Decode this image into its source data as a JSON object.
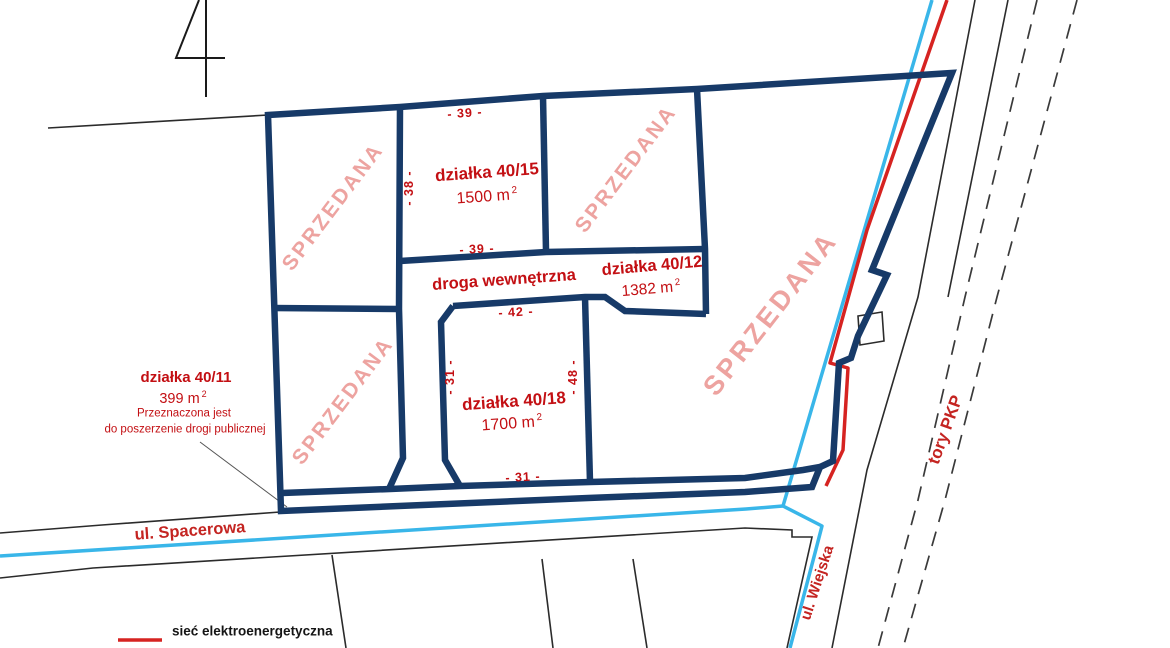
{
  "map": {
    "parcel_number": "4",
    "sold_label": "SPRZEDANA",
    "road_label": "droga wewnętrzna",
    "plots": {
      "p40_15": {
        "name": "działka 40/15",
        "area": "1500 m",
        "area_sup": "2"
      },
      "p40_12": {
        "name": "działka 40/12",
        "area": "1382 m",
        "area_sup": "2"
      },
      "p40_18": {
        "name": "działka 40/18",
        "area": "1700 m",
        "area_sup": "2"
      },
      "p40_11": {
        "name": "działka 40/11",
        "area": "399 m",
        "area_sup": "2",
        "note_line1": "Przeznaczona jest",
        "note_line2": "do poszerzenie drogi publicznej"
      }
    },
    "dims": {
      "top_39": "- 39 -",
      "bottom_39": "- 39 -",
      "left_38": "- 38 -",
      "top_42": "- 42 -",
      "left_31": "- 31 -",
      "right_48": "- 48 -",
      "bottom_31": "- 31 -"
    },
    "streets": {
      "spacerowa": "ul. Spacerowa",
      "wiejska": "ul. Wiejska",
      "railway": "tory PKP"
    }
  },
  "legend": {
    "electric_label": "sieć elektroenergetyczna"
  },
  "colors": {
    "boundary_navy": "#173a68",
    "sold_pink": "#eda3a0",
    "label_red": "#c30f13",
    "street_red": "#c42421",
    "water_cyan": "#39b6e9",
    "electric_red": "#d62321",
    "line_black": "#2b2b2b",
    "rail_dash": "#3a3a3a"
  }
}
